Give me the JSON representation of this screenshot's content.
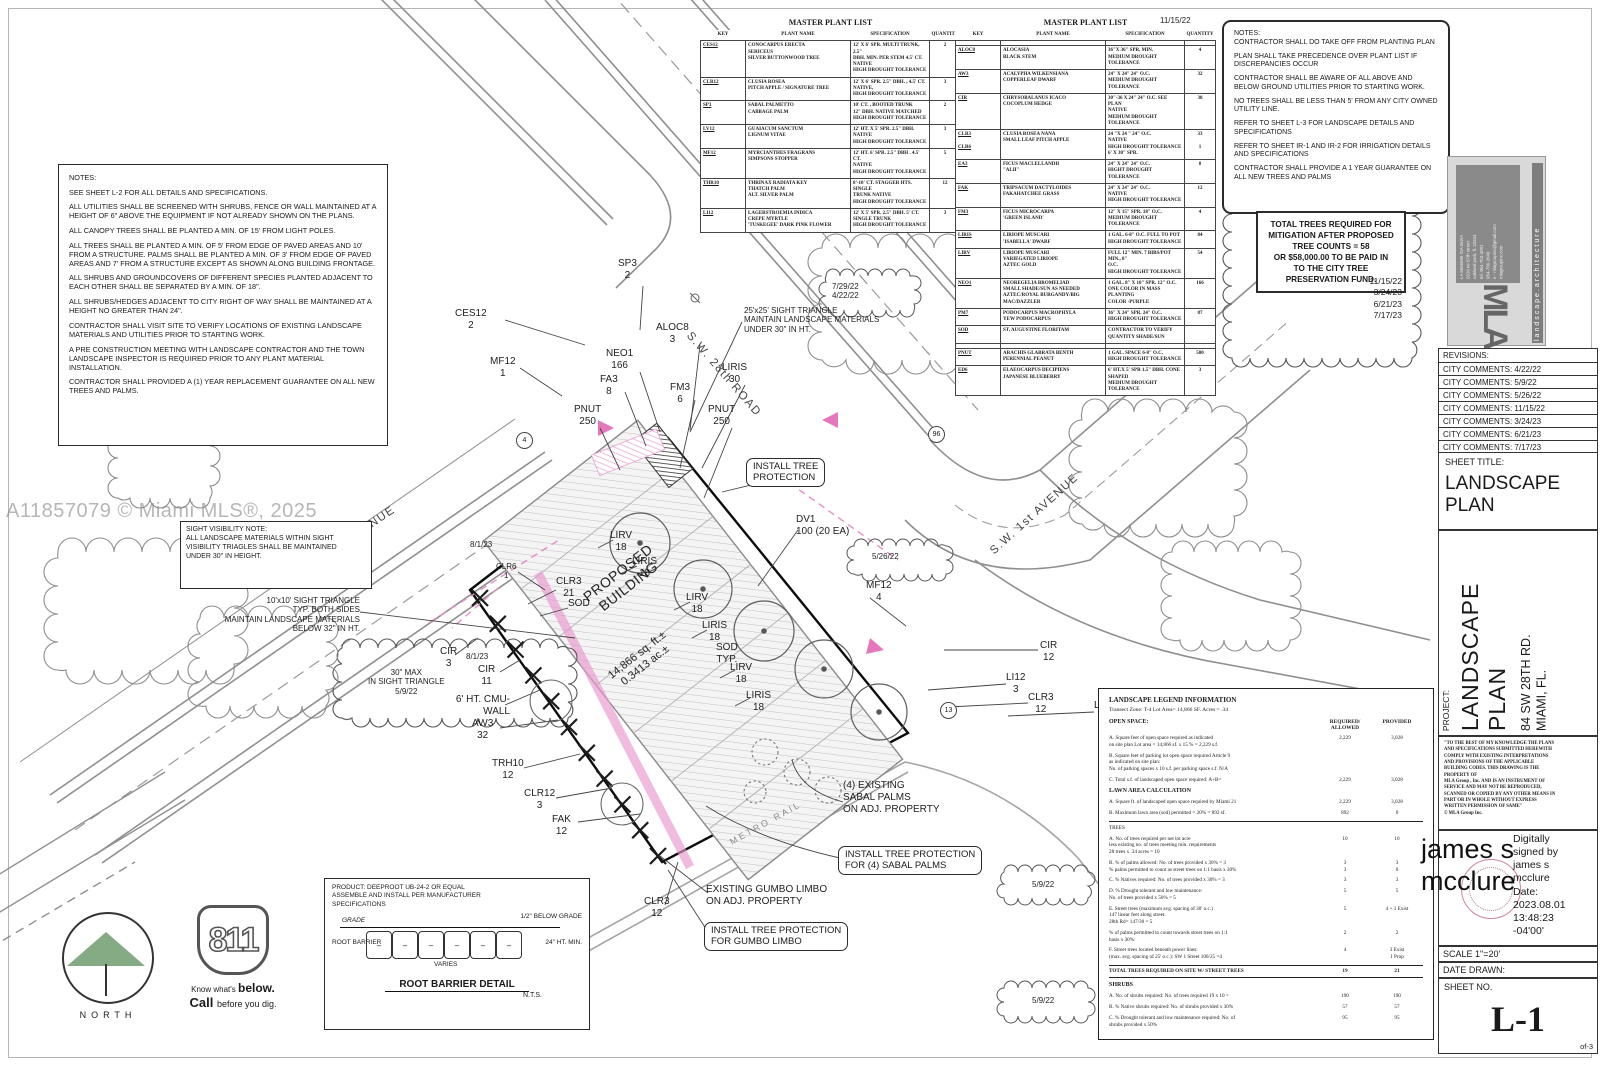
{
  "watermark": "A11857079 © Miami MLS®, 2025",
  "notes_left": {
    "title": "NOTES:",
    "items": [
      "SEE SHEET L-2 FOR ALL DETAILS AND SPECIFICATIONS.",
      "ALL UTILITIES SHALL BE SCREENED WITH SHRUBS, FENCE OR WALL MAINTAINED AT A HEIGHT OF 6\" ABOVE THE EQUIPMENT IF NOT ALREADY SHOWN ON THE PLANS.",
      "ALL CANOPY TREES SHALL BE PLANTED A MIN. OF 15' FROM LIGHT POLES.",
      "ALL TREES SHALL BE PLANTED A MIN. OF 5' FROM EDGE OF PAVED AREAS AND 10' FROM A STRUCTURE.  PALMS SHALL BE PLANTED A MIN. OF 3' FROM EDGE OF PAVED AREAS AND 7' FROM A STRUCTURE EXCEPT AS SHOWN ALONG BUILDING FRONTAGE.",
      "ALL SHRUBS AND GROUNDCOVERS OF DIFFERENT SPECIES PLANTED ADJACENT TO EACH OTHER SHALL BE SEPARATED BY A MIN. OF 18\".",
      "ALL SHRUBS/HEDGES ADJACENT TO CITY RIGHT OF WAY SHALL BE MAINTAINED AT A HEIGHT NO GREATER THAN 24\".",
      "CONTRACTOR SHALL VISIT SITE  TO VERIFY LOCATIONS OF EXISTING LANDSCAPE MATERIALS AND UTILITIES PRIOR TO STARTING WORK.",
      "A PRE CONSTRUCTION MEETING WITH LANDSCAPE CONTRACTOR AND THE TOWN LANDSCAPE INSPECTOR  IS REQUIRED PRIOR TO ANY PLANT MATERIAL INSTALLATION.",
      "CONTRACTOR SHALL PROVIDED A (1) YEAR REPLACEMENT GUARANTEE ON ALL NEW TREES AND PALMS."
    ]
  },
  "sight_note": {
    "title": "SIGHT VISIBILITY NOTE:",
    "body": "ALL LANDSCAPE MATERIALS WITHIN SIGHT\nVISIBILITY TRIAGLES SHALL BE MAINTAINED\nUNDER 30\" IN HEIGHT."
  },
  "plant_list_1": {
    "title": "MASTER PLANT LIST",
    "headers": [
      "KEY",
      "PLANT NAME",
      "SPECIFICATION",
      "QUANTITY"
    ],
    "rows": [
      [
        "CES12",
        "CONOCARPUS  ERECTA\nSERICEUS\nSILVER BUTTONWOOD TREE",
        "12' X 6' SPR.  MULTI TRUNK, 2.5\"\nDBH. MIN. PER STEM 4.5' CT.\nNATIVE\nHIGH DROUGHT TOLERANCE",
        "2"
      ],
      [
        "CLR12",
        "CLUSIA ROSEA\nPITCH APPLE / SIGNATURE TREE",
        "12' X 6' SPR.  2.5\" DBH. , 4.5' CT.\nNATIVE,\nHIGH DROUGHT TOLERANCE",
        "3"
      ],
      [
        "SP3",
        "SABAL PALMETTO\nCABBAGE PALM",
        "10' CT. ,   BOOTED TRUNK\n12\" DBH.  NATIVE MATCHED\nHIGH DROUGHT TOLERANCE",
        "2"
      ],
      [
        "LV12",
        "GUAIACUM SANCTUM\nLIGNUM VITAE",
        "12' HT. X 5' SPR. 2.5\" DBH.\nNATIVE\nHIGH DROUGHT TOLERANCE",
        "3"
      ],
      [
        "MF12",
        "MYRCIANTHES FRAGRANS\nSIMPSONS STOPPER",
        "12' HT. 6' SPR.  2.5\" DBH . 4.5' CT.\nNATIVE\nHIGH DROUGHT TOLERANCE",
        "5"
      ],
      [
        "THR10",
        "THRINAX RADIATA    KEY\nTHATCH PALM\nALT. SILVER PALM",
        "8'-10' CT.  STAGGER HTS.  SINGLE\nTRUNK  NATIVE\nHIGH DROUGHT TOLERANCE",
        "12"
      ],
      [
        "LI12",
        "LAGERSTROEMIA INDICA\nCREPE MYRTLE\n'TUSKEGEE'  DARK PINK FLOWER",
        "12' X 5' SPR.  2.5\" DBH.  5' CT.\nSINGLE TRUNK\nHIGH DROUGHT TOLERANCE",
        "3"
      ]
    ]
  },
  "plant_list_2": {
    "title": "MASTER PLANT LIST",
    "date": "11/15/22",
    "side_dates": [
      "8/1/23",
      "8/1/23"
    ],
    "headers": [
      "KEY",
      "PLANT NAME",
      "SPECIFICATION",
      "QUANTITY"
    ],
    "rows": [
      [
        "",
        "",
        "",
        ""
      ],
      [
        "ALOC8",
        "ALOCASIA\nBLACK STEM",
        "36\"X 36\" SPR.  MIN.\nMEDIUM DROUGHT TOLERANCE",
        "4"
      ],
      [
        "AW3",
        "ACALYPHA WILKENSIANA\nCOPPERLEAF DWARF",
        "24\" X 24\"  24\" O.C.\nMEDIUM DROUGHT TOLERANCE",
        "32"
      ],
      [
        "CIR",
        "CHRYSOBALANUS ICACO\nCOCOPLUM HEDGE",
        "30\"-36 X 24\"  24\" O.C.  SEE PLAN\nNATIVE\nMEDIUM DROUGHT TOLERANCE",
        "38"
      ],
      [
        "CLR3\n\nCLR6",
        "CLUSIA ROSEA  NANA\nSMALL LEAF PITCH APPLE",
        "24 \"X 24 \" 24\"  O.C.\nNATIVE\nHIGH DROUGHT TOLERANCE\n6' X 30\" SPR.",
        "33\n\n1"
      ],
      [
        "EA3",
        "FICUS MACLELLANDII\n\"ALII\"",
        "24\" X 24\" 24\" O.C.\nHIGHT DROUGHT TOLERANCE",
        "8"
      ],
      [
        "FAK",
        "TRIPSACUM DACTYLOIDES\nFAKAHATCHEE GRASS",
        "24\" X 24\" 24\" O.C.\nNATIVE\nHIGH DROUGHT TOLERANCE",
        "12"
      ],
      [
        "FM3",
        "FICUS MICROCARPA\n'GREEN ISLAND'",
        "12\" X 15\" SPR. 18\"  O.C.\nMEDIUM DROUGHT TOLERANCE",
        "4"
      ],
      [
        "LIRIS",
        "LIRIOPE MUSCARI\n'ISABELLA' DWARF",
        "1 GAL. 6-8\" O.C. FULL TO POT\nHIGH DROUGHT TOLERANCE",
        "84"
      ],
      [
        "LIRV",
        "LIRIOPE MUSCARI\nVARIEGATED LIRIOPE\nAZTEC GOLD",
        "FULL 12\" MIN. 7 BIBS/POT MIN.,  8\"\nO.C.\nHIGH DROUGHT TOLERANCE",
        "54"
      ],
      [
        "NEO1",
        "NEOREGELIA BROMELIAD\nSMALL SHADE/SUN AS NEEDED\nAZTEC/ROYAL BURGANDY/BIG\nMAC/DAZZLER",
        "1 GAL. 8\" X 10\" SPR. 12\" O.C.\nONE COLOR IN MASS PLANTING\nCOLOR -PURPLE",
        "166"
      ],
      [
        "PM7",
        "PODOCARPUS MACROPHYLA\nYEW PODOCARPUS",
        "36\" X 24\" SPR. 24\" O.C.\nHIGH DROUGHT TOLERANCE",
        "87"
      ],
      [
        "SOD",
        "ST. AUGUSTINE FLORITAM",
        "CONTRACTOR TO VERIFY\nQUANTITY  SHADE/SUN",
        ""
      ],
      [
        "",
        "",
        "",
        ""
      ],
      [
        "PNUT",
        "ARACHIS GLABRATA BENTH\nPERENNIAL PEANUT",
        "1 GAL. SPACE 6-8\"  O.C.\nHIGH DROUGHT TOLERANCE",
        "500"
      ],
      [
        "ED6",
        "ELAEOCARPUS DECIPIENS\nJAPANESE BLUEBERRY",
        "6' HT.X 5' SPR  1.5\" DBH.  CONE\nSHAPED\nMEDIUM DROUGHT TOLERANCE",
        "3"
      ]
    ]
  },
  "notes_right": {
    "title": "NOTES:",
    "items": [
      "CONTRACTOR SHALL DO TAKE OFF FROM PLANTING PLAN",
      "PLAN SHALL TAKE PRECEDENCE OVER PLANT LIST IF DISCREPANCIES OCCUR",
      "CONTRACTOR SHALL BE AWARE OF ALL ABOVE AND BELOW GROUND UTILITIES PRIOR TO STARTING WORK.",
      "NO TREES SHALL BE LESS THAN 5' FROM ANY CITY OWNED UTILITY LINE.",
      "REFER TO SHEET L-3 FOR LANDSCAPE DETAILS AND SPECIFICATIONS",
      "REFER TO SHEET IR-1 AND IR-2 FOR IRRIGATION DETAILS AND SPECIFICATIONS",
      "CONTRACTOR SHALL PROVIDE A 1 YEAR GUARANTEE ON ALL NEW TREES AND PALMS"
    ]
  },
  "mitigation_box": "TOTAL TREES REQUIRED FOR\nMITIGATION AFTER PROPOSED\nTREE COUNTS = 58\nOR $58,000.00 TO BE PAID IN\nTO THE CITY TREE\nPRESERVATION FUND.",
  "cloud_dates": "11/15/22\n3/24/23\n6/21/23\n7/17/23",
  "cloud_date_left": "5/9/22",
  "logo_card": {
    "firm": "landscape.architecture",
    "address": "LA 6666696   ISA 062/A\n2016 ne 67th street\noakland park, fl. 33334\ntel. 954-703-4091\n954-766-2049\ne - mlagroupinc@gmail.com\nmlagroupinc.com",
    "mark": "MLA"
  },
  "titleblock": {
    "revisions_title": "REVISIONS:",
    "revisions": [
      "CITY COMMENTS: 4/22/22",
      "CITY COMMENTS: 5/9/22",
      "CITY COMMENTS: 5/26/22",
      "CITY COMMENTS: 11/15/22",
      "CITY COMMENTS: 3/24/23",
      "CITY COMMENTS: 6/21/23",
      "CITY COMMENTS: 7/17/23",
      "CITY COMMENTS: 8/1/23"
    ],
    "sheet_title_label": "SHEET TITLE:",
    "sheet_title": "LANDSCAPE\nPLAN",
    "project_label": "PROJECT:",
    "project_name": "LANDSCAPE PLAN",
    "project_address": "84 SW 28TH RD.\nMIAMI, FL.",
    "disclaimer": "\"TO THE BEST OF MY KNOWLEDGE THE PLANS\nAND SPECIFICATIONS SUBMITTED HEREWITH\nCOMPLY WITH EXISTING INTERPRETATIONS\nAND PROVISIONS OF THE APPLICABLE\nBUILDING CODES.  THIS DRAWING IS THE\nPROPERTY OF\nMLA Group , Inc. AND IS AN INSTRUMENT OF\nSERVICE AND MAY NOT BE REPRODUCED,\nSCANNED OR COPIED BY ANY OTHER MEANS IN\nPART OR IN WHOLE WITHOUT EXPRESS\nWRITTEN PERMISSION OF SAME\"\n©  MLA Group Inc.",
    "signature_name": "james s mcclure",
    "signature_details": "Digitally\nsigned by\njames s\nmcclure\nDate:\n2023.08.01\n13:48:23\n-04'00'",
    "scale": "SCALE  1\"=20'",
    "date_drawn_label": "DATE DRAWN:",
    "sheet_no_label": "SHEET NO.",
    "sheet_no": "L-1",
    "of": "of-3"
  },
  "legend": {
    "title": "LANDSCAPE LEGEND INFORMATION",
    "subtitle": "Transect Zone:  T-4        Lot Area=      14,866 SF.      Acres = .34",
    "open_space": "OPEN SPACE:",
    "col_required": "REQUIRED/\nALLOWED",
    "col_provided": "PROVIDED",
    "rows": [
      {
        "y": "item",
        "t": "A.  Square feet of open space required as indicated\non site plan    Lot area = 14,866 sf.  x 15 % = 2,229 s.f.",
        "r": "2,229",
        "p": "3,028"
      },
      {
        "y": "item",
        "t": "B.  Square feet of parking lot open space required Article 9\n        as indicated on site plan:\nNo. of parking spaces  x 10 s.f. per parking space  s.f.  N/A",
        "r": "",
        "p": ""
      },
      {
        "y": "item",
        "t": "C.  Total s.f. of landscaped open space  required: A+B=",
        "r": "2,229",
        "p": "3,028"
      },
      {
        "y": "sec",
        "t": "LAWN AREA CALCULATION",
        "r": "",
        "p": ""
      },
      {
        "y": "item",
        "t": "A.  Square ft. of landscaped open space required by Miami 21",
        "r": "2,229",
        "p": "3,028"
      },
      {
        "y": "item",
        "t": "B.  Maximum lawn area (sod) permitted =   20% = 892 sf.",
        "r": "892",
        "p": "0"
      },
      {
        "y": "sec2",
        "t": "TREES",
        "r": "",
        "p": ""
      },
      {
        "y": "item",
        "t": "A.  No. of trees required per net lot acre\n      less existing no. of trees meeting min. requirements\n      28  trees x .34 acres = 10",
        "r": "10",
        "p": "10"
      },
      {
        "y": "item",
        "t": "B.  % of palms allowed: No. of trees provided x 30% = 3\n      % palms permitted to count as street trees  on 1:1 basis x 30%",
        "r": "3\n3",
        "p": "3\n0"
      },
      {
        "y": "item",
        "t": "C.  % Natives required: No. of trees provided x 30% = 3",
        "r": "3",
        "p": "3"
      },
      {
        "y": "item",
        "t": "D.  % Drought tolerant and low maintenance:\n      No. of trees provided x 50% = 5",
        "r": "5",
        "p": "5"
      },
      {
        "y": "item",
        "t": "E.  Street trees (maximum avg. spacing of 30' o.c.)\n      147  linear feet along street.\n      28th Rd= 147/30 = 5",
        "r": "5",
        "p": "4 + 1 Exist"
      },
      {
        "y": "item",
        "t": "      % of palms permitted to count towards street trees on 1:1\n      basis x 30%:",
        "r": "2",
        "p": "2"
      },
      {
        "y": "item",
        "t": "F.  Street trees located beneath power lines:\n      (max. avg. spacing of 25' o.c.): SW 1 Street 100/25 =4",
        "r": "4",
        "p": "3 Exist\n1 Prop"
      },
      {
        "y": "total",
        "t": "TOTAL TREES REQUIRED ON SITE W/ STREET TREES",
        "r": "19",
        "p": "21"
      },
      {
        "y": "sec",
        "t": "SHRUBS",
        "r": "",
        "p": ""
      },
      {
        "y": "item",
        "t": "A.  No. of shrubs required: No. of trees required 19 x 10 =",
        "r": "190",
        "p": "190"
      },
      {
        "y": "item",
        "t": "B.  % Native shrubs required: No. of shrubs provided x 30%",
        "r": "57",
        "p": "57"
      },
      {
        "y": "item",
        "t": "C.  % Drought tolerant and low maintenance required: No. of\nshrubs provided x 50%",
        "r": "95",
        "p": "95"
      }
    ]
  },
  "root_barrier": {
    "product": "PRODUCT: DEEPROOT UB-24-2 OR EQUAL\nASSEMBLE AND INSTALL PER MANUFACTURER\nSPECIFICATIONS",
    "grade": "GRADE",
    "below": "1/2\" BELOW GRADE",
    "barrier": "ROOT BARRIER",
    "ht": "24\" HT. MIN.",
    "varies": "VARIES",
    "title": "ROOT BARRIER DETAIL",
    "nts": "N.T.S.",
    "dash": "–"
  },
  "north_label": "NORTH",
  "call811": {
    "number": "811",
    "know": "Know what's ",
    "below": "below.",
    "call": "Call ",
    "dig": "before you dig."
  },
  "plan": {
    "streets": {
      "sw28": "S.W. 28th ROAD",
      "sw1_left": "S.W. 1st AVENUE",
      "sw1_right": "S.W. 1st AVENUE",
      "metro": "METRO RAIL"
    },
    "circled": {
      "c4": "4",
      "c96": "96",
      "c13": "13"
    },
    "labels": {
      "sp3": "SP3\n2",
      "ces12": "CES12\n2",
      "mf12_1": "MF12\n1",
      "neo1": "NEO1\n166",
      "fa3": "FA3\n8",
      "aloc8": "ALOC8\n3",
      "liris30": "LIRIS\n30",
      "fm3": "FM3\n6",
      "pnut_left": "PNUT\n250",
      "pnut_right": "PNUT\n250",
      "dates_top": "7/29/22\n4/22/22",
      "sight25": "25'x25' SIGHT TRIANGLE\nMAINTAIN LANDSCAPE MATERIALS\nUNDER 30\" IN HT.",
      "install_tp": "INSTALL TREE\nPROTECTION",
      "date_81a": "8/1/23",
      "clr6": "CLR6\n1",
      "clr3_21": "CLR3\n21",
      "sod": "SOD",
      "lirv_a": "LIRV\n18",
      "liris_a": "LIRIS\n18",
      "lirv_b": "LIRV\n18",
      "liris_b": "LIRIS\n18",
      "sod_typ": "SOD\nTYP.",
      "lirv_c": "LIRV\n18",
      "liris_c": "LIRIS\n18",
      "building": "PROPOSED\nBUILDING",
      "bldg_area": "14,866 sq. ft.±\n0.3413 ac.±",
      "dv1": "DV1\n100 (20 EA)",
      "date_5_26": "5/26/22",
      "mf12_4": "MF12\n4",
      "cir12": "CIR\n12",
      "li12": "LI12\n3",
      "clr3_r": "CLR3\n12",
      "lv12": "LV12\n3",
      "sight10": "10'x10' SIGHT TRIANGLE\nTYP. BOTH SIDES\nMAINTAIN LANDSCAPE MATERIALS\nBELOW 32\" IN HT.",
      "cir3": "CIR\n3",
      "date_81b": "8/1/23",
      "cir11": "CIR\n11",
      "cloud30": "30\" MAX\nIN SIGHT TRIANGLE\n5/9/22",
      "cmu": "6' HT. CMU-\nWALL",
      "aw3": "AW3\n32",
      "trh10": "TRH10\n12",
      "clr12": "CLR12\n3",
      "fak": "FAK\n12",
      "sabal": "(4) EXISTING\nSABAL PALMS\nON ADJ. PROPERTY",
      "tp_sabal": "INSTALL TREE PROTECTION\nFOR (4) SABAL PALMS",
      "gumbo": "EXISTING GUMBO LIMBO\nON ADJ. PROPERTY",
      "tp_gumbo": "INSTALL TREE PROTECTION\nFOR GUMBO LIMBO",
      "clr3_b": "CLR3\n12",
      "date_59a": "5/9/22",
      "date_59b": "5/9/22"
    }
  }
}
